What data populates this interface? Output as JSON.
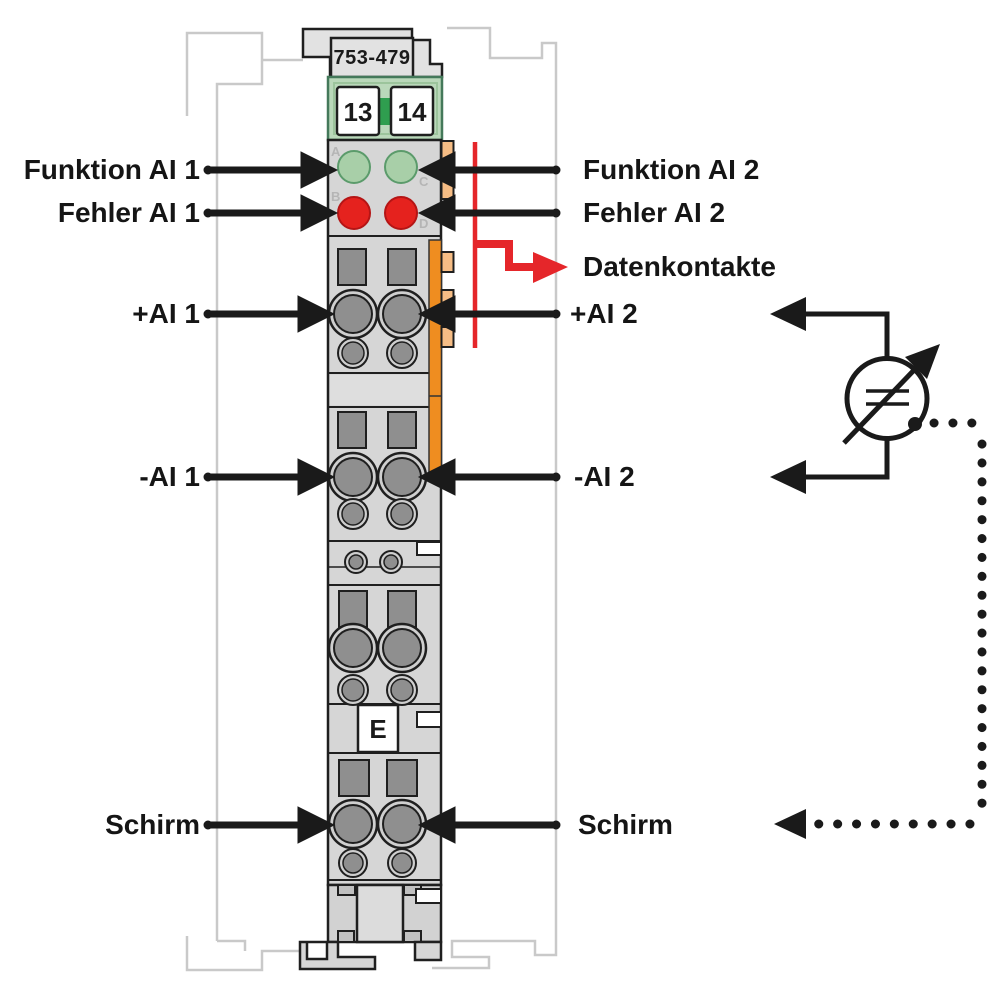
{
  "diagram": {
    "module": {
      "part_number": "753-479",
      "terminals": [
        "13",
        "14"
      ],
      "led_markers": [
        "A",
        "B",
        "C",
        "D"
      ],
      "earth_label": "E"
    },
    "left_labels": {
      "funktion_ai_1": "Funktion AI 1",
      "fehler_ai_1": "Fehler AI 1",
      "plus_ai_1": "+AI 1",
      "minus_ai_1": "-AI 1",
      "schirm": "Schirm"
    },
    "right_labels": {
      "funktion_ai_2": "Funktion AI 2",
      "fehler_ai_2": "Fehler AI 2",
      "datenkontakte": "Datenkontakte",
      "plus_ai_2": "+AI 2",
      "minus_ai_2": "-AI 2",
      "schirm": "Schirm"
    },
    "colors": {
      "led_green": "#a8cfa8",
      "led_red": "#e5221e",
      "module_green": "#bad8ba",
      "center_green": "#2f9e4f",
      "contact_orange": "#ef8d20",
      "contact_orange_light": "#f6bd85",
      "data_red": "#e5262a",
      "body_gray": "#d6d6d6"
    }
  }
}
